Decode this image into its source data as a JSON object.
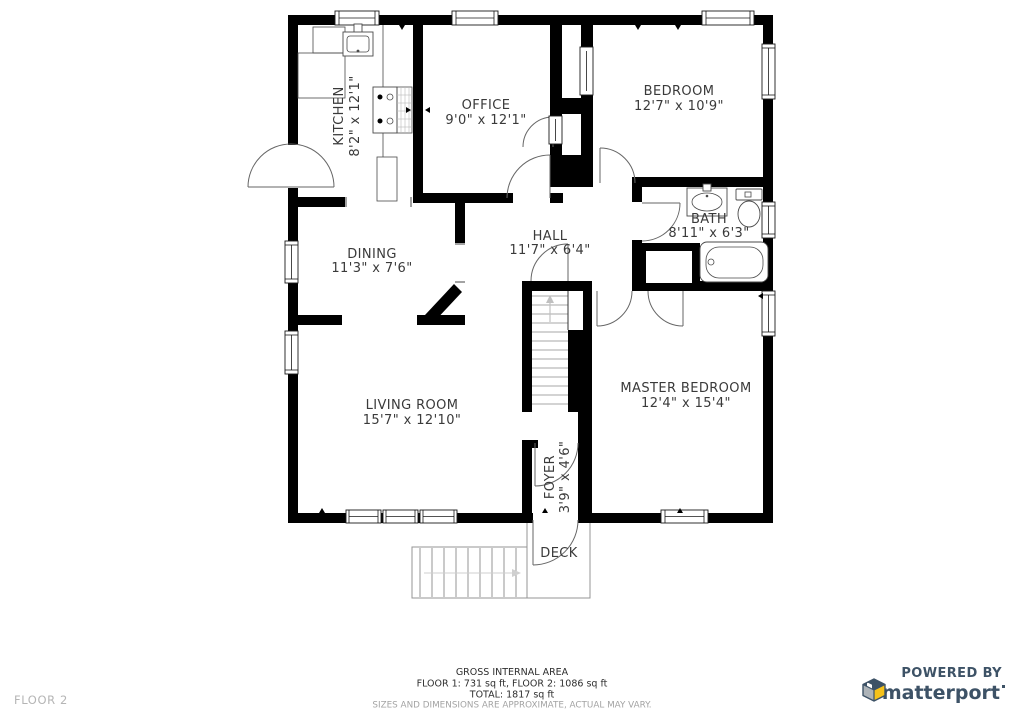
{
  "floor_label": "FLOOR 2",
  "rooms": {
    "kitchen": {
      "name": "KITCHEN",
      "dims": "8'2\" x 12'1\""
    },
    "office": {
      "name": "OFFICE",
      "dims": "9'0\" x 12'1\""
    },
    "bedroom": {
      "name": "BEDROOM",
      "dims": "12'7\" x 10'9\""
    },
    "bath": {
      "name": "BATH",
      "dims": "8'11\" x 6'3\""
    },
    "dining": {
      "name": "DINING",
      "dims": "11'3\" x 7'6\""
    },
    "hall": {
      "name": "HALL",
      "dims": "11'7\" x 6'4\""
    },
    "living": {
      "name": "LIVING ROOM",
      "dims": "15'7\" x 12'10\""
    },
    "master": {
      "name": "MASTER BEDROOM",
      "dims": "12'4\" x 15'4\""
    },
    "foyer": {
      "name": "FOYER",
      "dims": "3'9\" x 4'6\""
    },
    "deck": {
      "name": "DECK"
    }
  },
  "footer": {
    "area_title": "GROSS INTERNAL AREA",
    "area_floors": "FLOOR 1: 731 sq ft, FLOOR 2: 1086 sq ft",
    "area_total": "TOTAL: 1817 sq ft",
    "disclaimer": "SIZES AND DIMENSIONS ARE APPROXIMATE, ACTUAL MAY VARY."
  },
  "branding": {
    "powered_by": "POWERED BY",
    "brand": "matterport"
  },
  "colors": {
    "wall": "#000000",
    "door_arc": "#666666",
    "deck_outline": "#949494",
    "label_text": "#3a3a3a",
    "muted_text": "#a3a3a3",
    "floor_label_text": "#b5b5b5",
    "brand_navy": "#3d5266",
    "brand_yellow": "#f6c21a",
    "brand_gray": "#adb3b8"
  }
}
